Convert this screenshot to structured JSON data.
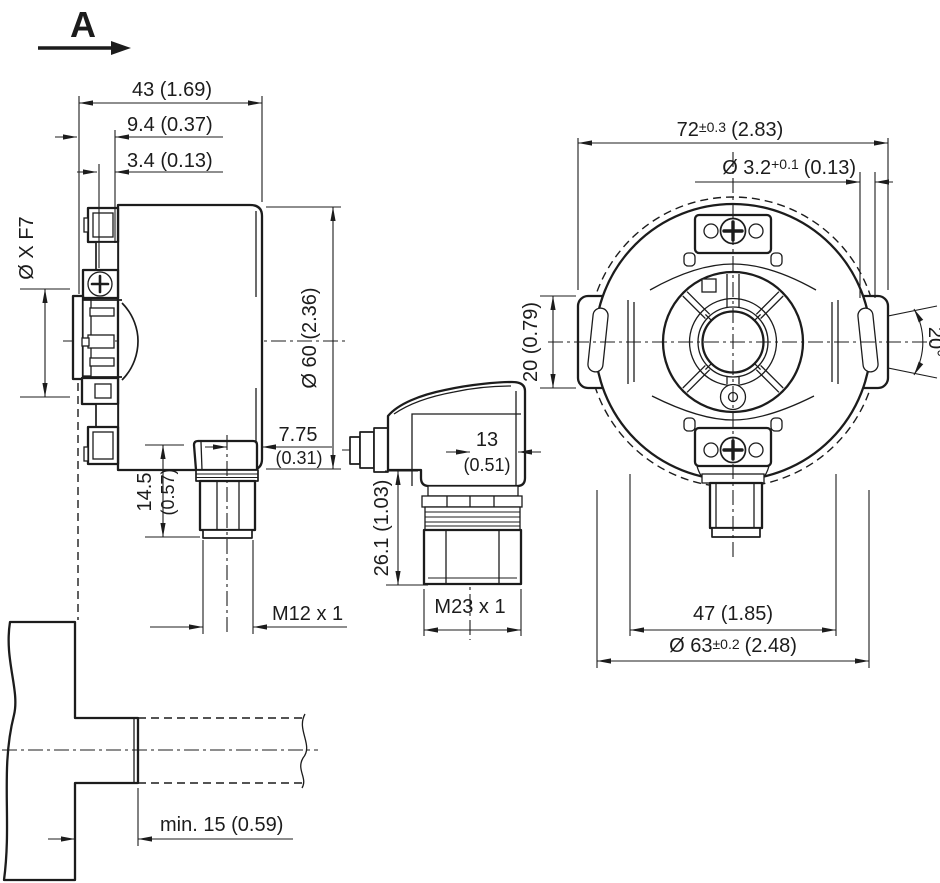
{
  "view_label": {
    "letter": "A"
  },
  "side_view": {
    "dim_width": "43 (1.69)",
    "dim_flange_offset": "9.4 (0.37)",
    "dim_step": "3.4 (0.13)",
    "dim_shaft_bore": "Ø X F7",
    "dim_housing_dia": "Ø 60 (2.36)",
    "dim_conn_offset_mm": "7.75",
    "dim_conn_offset_in": "(0.31)",
    "dim_conn_length_mm": "14.5",
    "dim_conn_length_in": "(0.57)",
    "thread_m12": "M12 x 1"
  },
  "connector_view": {
    "dim_depth_mm": "13",
    "dim_depth_in": "(0.51)",
    "dim_height": "26.1 (1.03)",
    "thread_m23": "M23 x 1"
  },
  "front_view": {
    "dim_overall": {
      "value": "72",
      "tol": "±0.3",
      "inch": "(2.83)"
    },
    "dim_pin_hole": {
      "value": "Ø 3.2",
      "tol": "+0.1",
      "inch": "(0.13)"
    },
    "dim_tab": "20 (0.79)",
    "dim_angle": "20°",
    "dim_spacing": "47 (1.85)",
    "dim_flange": {
      "value": "Ø 63",
      "tol": "±0.2",
      "inch": "(2.48)"
    }
  },
  "mount_view": {
    "dim_min_depth": "min. 15 (0.59)"
  }
}
